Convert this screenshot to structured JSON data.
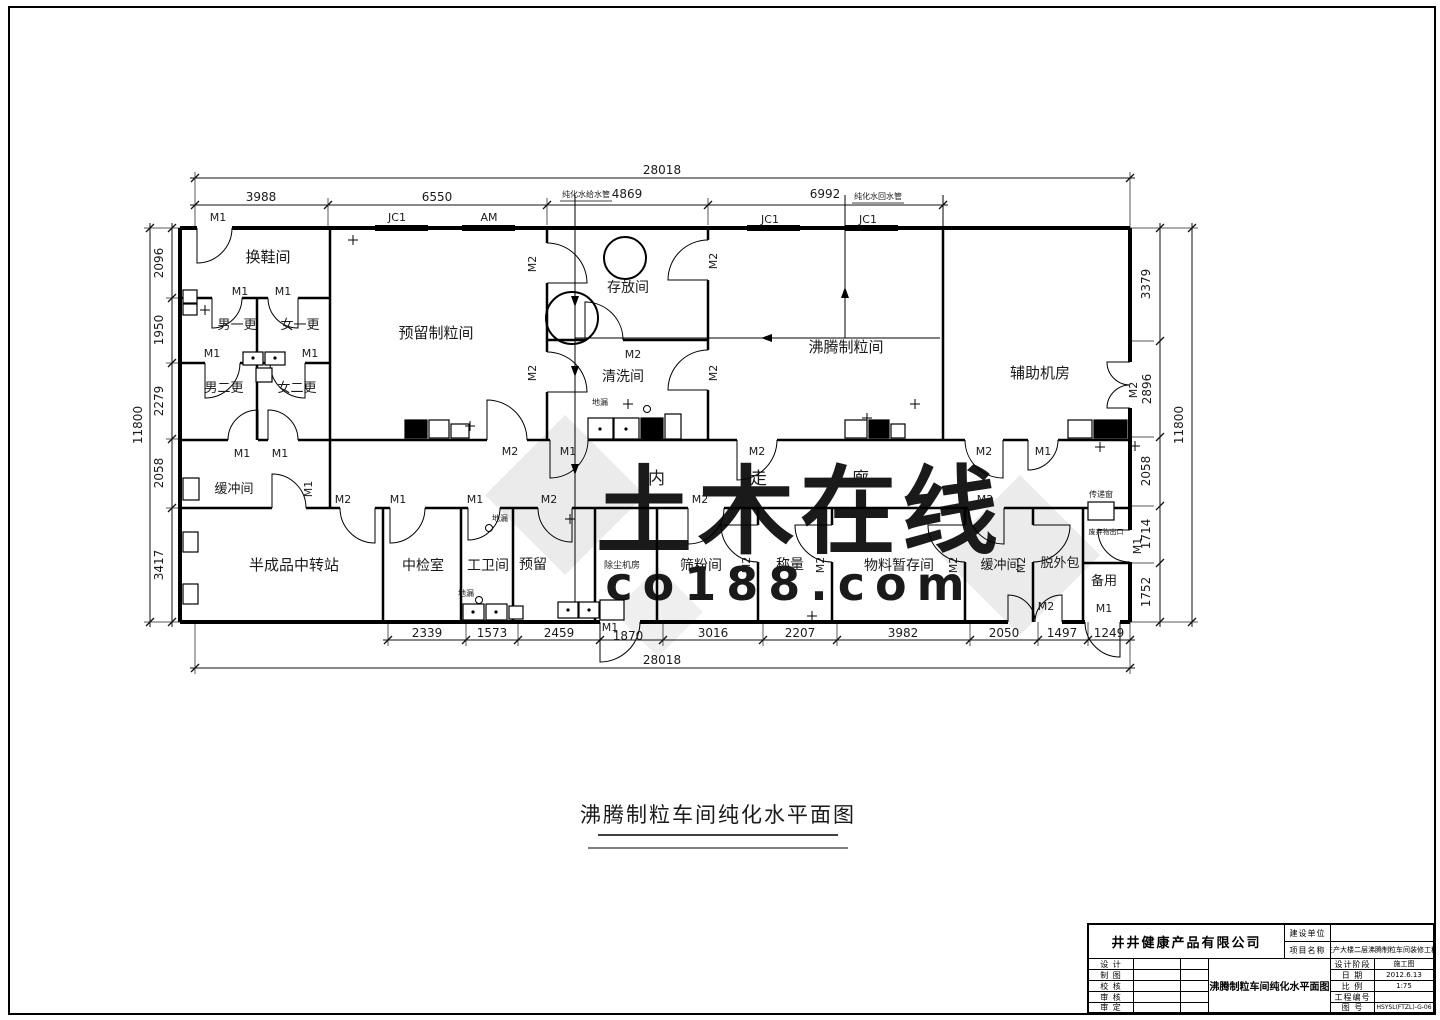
{
  "watermark": {
    "text": "土木在线",
    "sub": "co188.com"
  },
  "drawing_title": "沸腾制粒车间纯化水平面图",
  "labels": {
    "M1": "M1",
    "M2": "M2",
    "JC1": "JC1",
    "AM": "AM"
  },
  "rooms": {
    "shoe": "换鞋间",
    "m1c": "男一更",
    "f1c": "女一更",
    "m2c": "男二更",
    "f2c": "女二更",
    "reserved_gran": "预留制粒间",
    "storage": "存放间",
    "washing": "清洗间",
    "fbg": "沸腾制粒间",
    "aux": "辅助机房",
    "buffer": "缓冲间",
    "corridor": "内走廊",
    "semi": "半成品中转站",
    "inspect": "中检室",
    "toilet": "工卫间",
    "reserved": "预留",
    "dust": "除尘机房",
    "sieve": "筛粉间",
    "weigh": "称量",
    "material": "物料暂存间",
    "depack": "脱外包",
    "spare": "备用"
  },
  "annotations": {
    "floor_drain": "地漏",
    "pass_window": "传递窗",
    "waste_exit": "废弃物出口",
    "pipe_supply": "纯化水给水管",
    "pipe_return": "纯化水回水管"
  },
  "dims": {
    "top_total": "28018",
    "top_segments": [
      "3988",
      "6550",
      "4869",
      "6992"
    ],
    "left_segments": [
      "2096",
      "1950",
      "2279",
      "2058",
      "3417"
    ],
    "left_total": "11800",
    "right_segments": [
      "3379",
      "2896",
      "2058",
      "1714",
      "1752"
    ],
    "right_total": "11800",
    "bottom_segments": [
      "2339",
      "1573",
      "2459",
      "1870",
      "3016",
      "2207",
      "3982",
      "2050",
      "1497",
      "1249"
    ],
    "bottom_total": "28018"
  },
  "title_block": {
    "company": "井井健康产品有限公司",
    "owner_label": "建设单位",
    "owner_value": "",
    "project_label": "项目名称",
    "project_value": "生产大楼二层沸腾制粒车间装修工程",
    "rows": [
      "设 计",
      "制 图",
      "校 核",
      "审 核",
      "审 定"
    ],
    "drawing_name": "沸腾制粒车间纯化水平面图",
    "stage_label": "设计阶段",
    "stage_value": "施工图",
    "date_label": "日 期",
    "date_value": "2012.6.13",
    "scale_label": "比 例",
    "scale_value": "1:75",
    "project_no_label": "工程编号",
    "project_no_value": "",
    "dwg_no_label": "图 号",
    "dwg_no_value": "HSYSL(FTZL)-G-06"
  }
}
